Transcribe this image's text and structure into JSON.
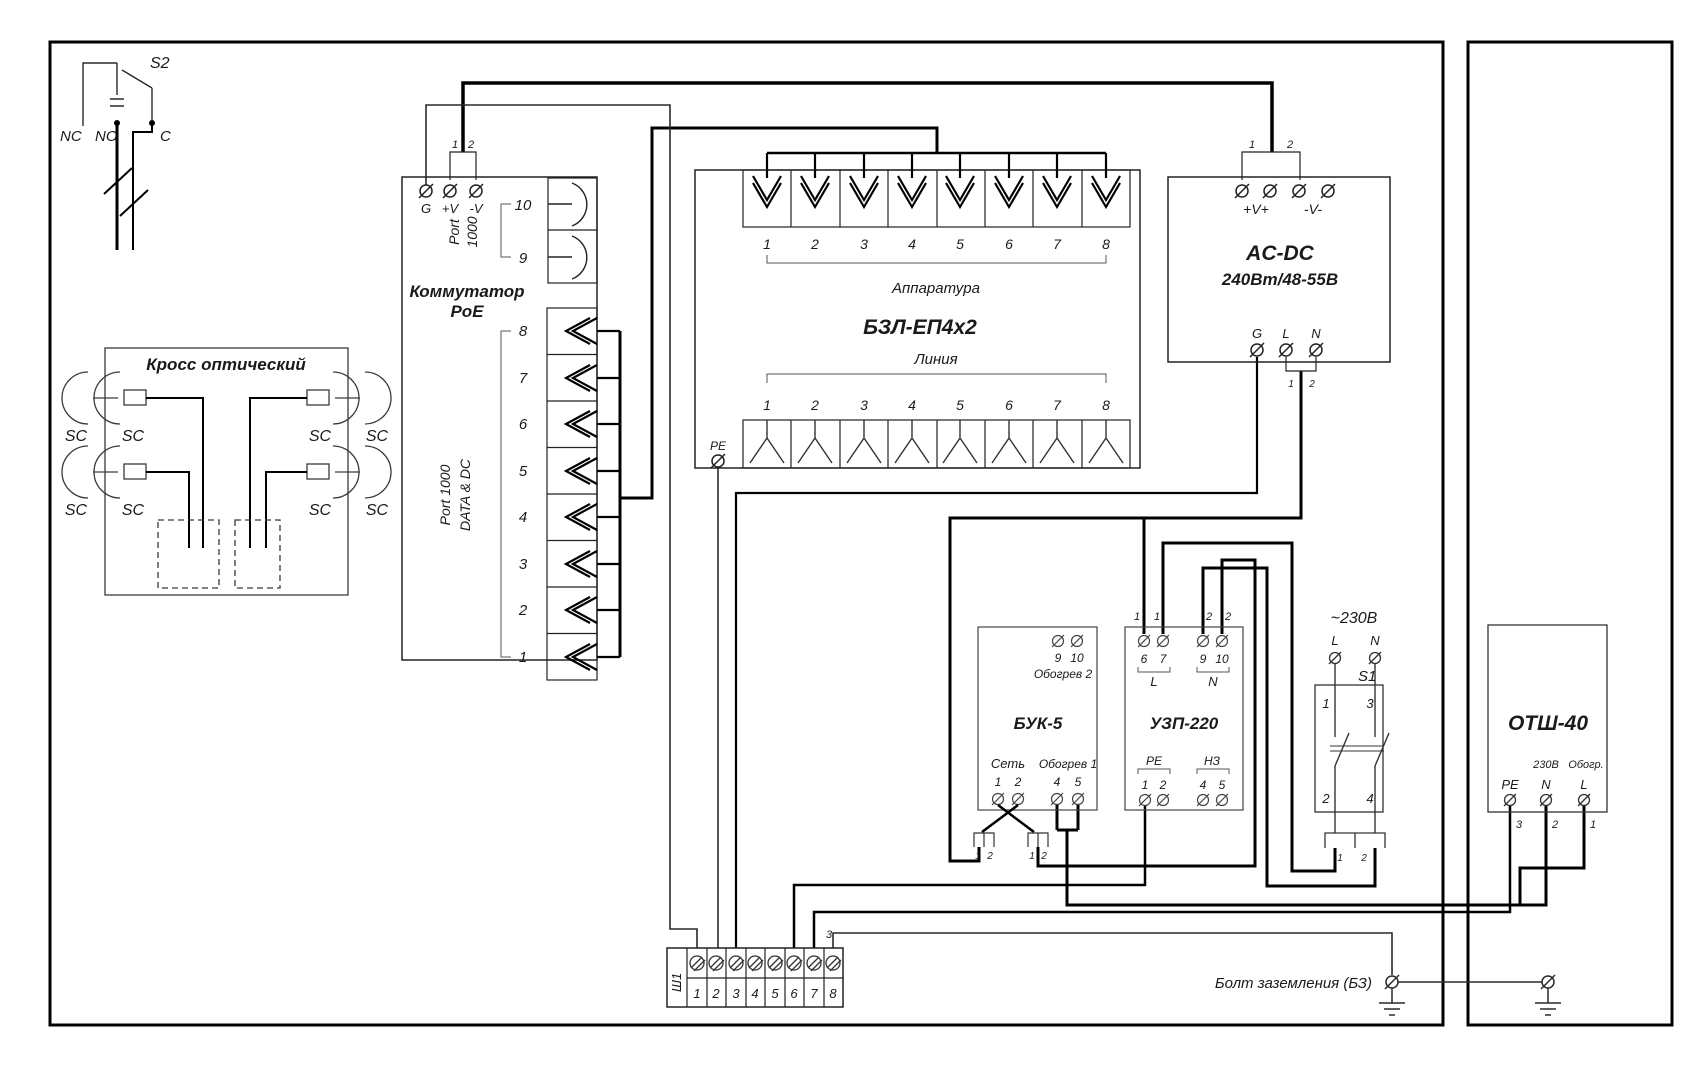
{
  "s2": {
    "label": "S2",
    "nc": "NC",
    "no": "NO",
    "c": "C"
  },
  "cross": {
    "title": "Кросс оптический",
    "sc": "SC"
  },
  "poe": {
    "title1": "Коммутатор",
    "title2": "PoE",
    "g": "G",
    "plusv": "+V",
    "minusv": "-V",
    "pin1": "1",
    "pin2": "2",
    "uplink_l1": "Port",
    "uplink_l2": "1000",
    "p10": "10",
    "p9": "9",
    "data_l1": "Port 1000",
    "data_l2": "DATA & DC",
    "ports": [
      "8",
      "7",
      "6",
      "5",
      "4",
      "3",
      "2",
      "1"
    ]
  },
  "bzl": {
    "title": "БЗЛ-ЕП4х2",
    "top_label": "Аппаратура",
    "bottom_label": "Линия",
    "pe": "PE",
    "top_ports": [
      "1",
      "2",
      "3",
      "4",
      "5",
      "6",
      "7",
      "8"
    ],
    "bottom_ports": [
      "1",
      "2",
      "3",
      "4",
      "5",
      "6",
      "7",
      "8"
    ]
  },
  "acdc": {
    "title1": "AC-DC",
    "title2": "240Вт/48-55В",
    "vplus": "+V+",
    "vminus": "-V-",
    "pin1": "1",
    "pin2": "2",
    "g": "G",
    "l": "L",
    "n": "N",
    "bpin1": "1",
    "bpin2": "2"
  },
  "buk": {
    "title": "БУК-5",
    "heat2": "Обогрев 2",
    "t9": "9",
    "t10": "10",
    "net": "Сеть",
    "heat1": "Обогрев 1",
    "t1": "1",
    "t2": "2",
    "t4": "4",
    "t5": "5",
    "c1p1": "1",
    "c1p2": "2",
    "c2p1": "1",
    "c2p2": "2"
  },
  "uzp": {
    "title": "УЗП-220",
    "pins": [
      "1",
      "1",
      "2",
      "2"
    ],
    "t6": "6",
    "t7": "7",
    "t9": "9",
    "t10": "10",
    "l": "L",
    "n": "N",
    "pe": "PE",
    "nz": "НЗ",
    "b1": "1",
    "b2": "2",
    "b4": "4",
    "b5": "5"
  },
  "s1": {
    "voltage": "~230В",
    "l": "L",
    "n": "N",
    "label": "S1",
    "c1": "1",
    "c3": "3",
    "c2": "2",
    "c4": "4",
    "p1": "1",
    "p2": "2"
  },
  "otsh": {
    "title": "ОТШ-40",
    "v230": "230В",
    "heat": "Обогр.",
    "pe": "PE",
    "n": "N",
    "l": "L",
    "w3": "3",
    "w2": "2",
    "w1": "1"
  },
  "sh1": {
    "label": "Ш1",
    "terminals": [
      "1",
      "2",
      "3",
      "4",
      "5",
      "6",
      "7",
      "8"
    ],
    "wire3": "3"
  },
  "ground": {
    "label": "Болт заземления (БЗ)"
  }
}
